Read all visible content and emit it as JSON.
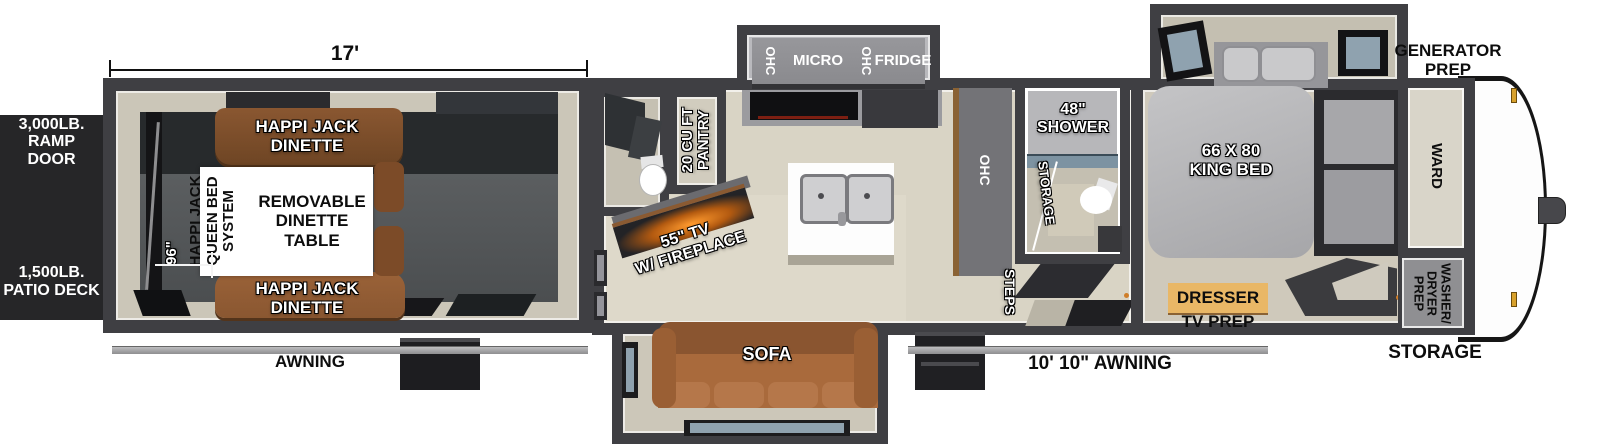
{
  "labels": {
    "garage_length": "17'",
    "garage_width": "96\"",
    "ramp_door": "3,000LB.\nRAMP DOOR",
    "patio_deck": "1,500LB.\nPATIO DECK",
    "awning_rear": "AWNING",
    "awning_main": "10' 10\" AWNING",
    "generator_prep": "GENERATOR\nPREP",
    "storage_front": "STORAGE",
    "dinette_top": "HAPPI JACK\nDINETTE",
    "dinette_bottom": "HAPPI JACK\nDINETTE",
    "queen_bed_system": "HAPPI JACK\nQUEEN BED\nSYSTEM",
    "removable_table": "REMOVABLE\nDINETTE\nTABLE",
    "pantry": "20 CU FT\nPANTRY",
    "tv_fireplace": "55\" TV\nW/ FIREPLACE",
    "ohc_left": "OHC",
    "micro": "MICRO",
    "ohc_mid": "OHC",
    "fridge": "FRIDGE",
    "ohc_kitchen": "OHC",
    "sofa": "SOFA",
    "steps": "STEPS",
    "shower": "48\"\nSHOWER",
    "storage_bath": "STORAGE",
    "king_bed": "66 X 80\nKING BED",
    "ward": "WARD",
    "washer_dryer": "WASHER/\nDRYER\nPREP",
    "dresser": "DRESSER",
    "tv_prep": "TV PREP"
  },
  "colors": {
    "wall": "#3f3f43",
    "beige": "#cbc6b8",
    "floor-light": "#d9d4c5",
    "garage-floor": "#55585a",
    "garage-dark": "#272a2c",
    "dinette-brown": "#8a5731",
    "sofa-brown": "#a96a3c",
    "dresser-tan": "#e9b766",
    "glass-blue": "#7d93a2",
    "fireplace-glow": "#ff9a2e",
    "black-panel": "#262628",
    "awning-gray": "#bdbdbf"
  }
}
